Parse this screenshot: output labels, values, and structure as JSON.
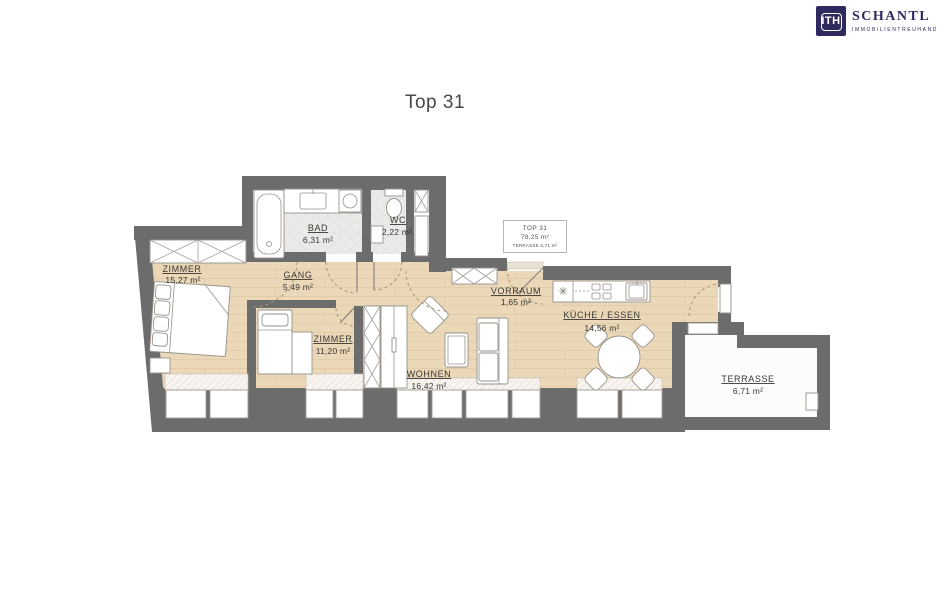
{
  "page": {
    "title": "Top 31"
  },
  "logo": {
    "monogram": "ITH",
    "company": "SCHANTL",
    "tagline": "IMMOBILIENTREUHAND",
    "navy": "#2e295e"
  },
  "info_box": {
    "unit": "TOP 31",
    "total_area": "78,25 m²",
    "terrace_note": "TERRASSE 6,71 m²"
  },
  "rooms": {
    "zimmer1": {
      "name": "ZIMMER",
      "area": "15,27 m²"
    },
    "gang": {
      "name": "GANG",
      "area": "5,49 m²"
    },
    "bad": {
      "name": "BAD",
      "area": "6,31 m²"
    },
    "wc": {
      "name": "WC",
      "area": "2,22 m²"
    },
    "zimmer2": {
      "name": "ZIMMER",
      "area": "11,20 m²"
    },
    "wohnen": {
      "name": "WOHNEN",
      "area": "16,42 m²"
    },
    "vorraum": {
      "name": "VORRAUM",
      "area": "1,65 m²"
    },
    "kueche": {
      "name": "KÜCHE / ESSEN",
      "area": "14,56 m²"
    },
    "terrasse": {
      "name": "TERRASSE",
      "area": "6,71 m²"
    }
  },
  "colors": {
    "wall": "#6d6c6d",
    "wood_floor": "#ebd8b9",
    "tile_floor": "#eceae8",
    "terrace_floor": "#fcfcfb",
    "label_text": "#3a3733"
  }
}
